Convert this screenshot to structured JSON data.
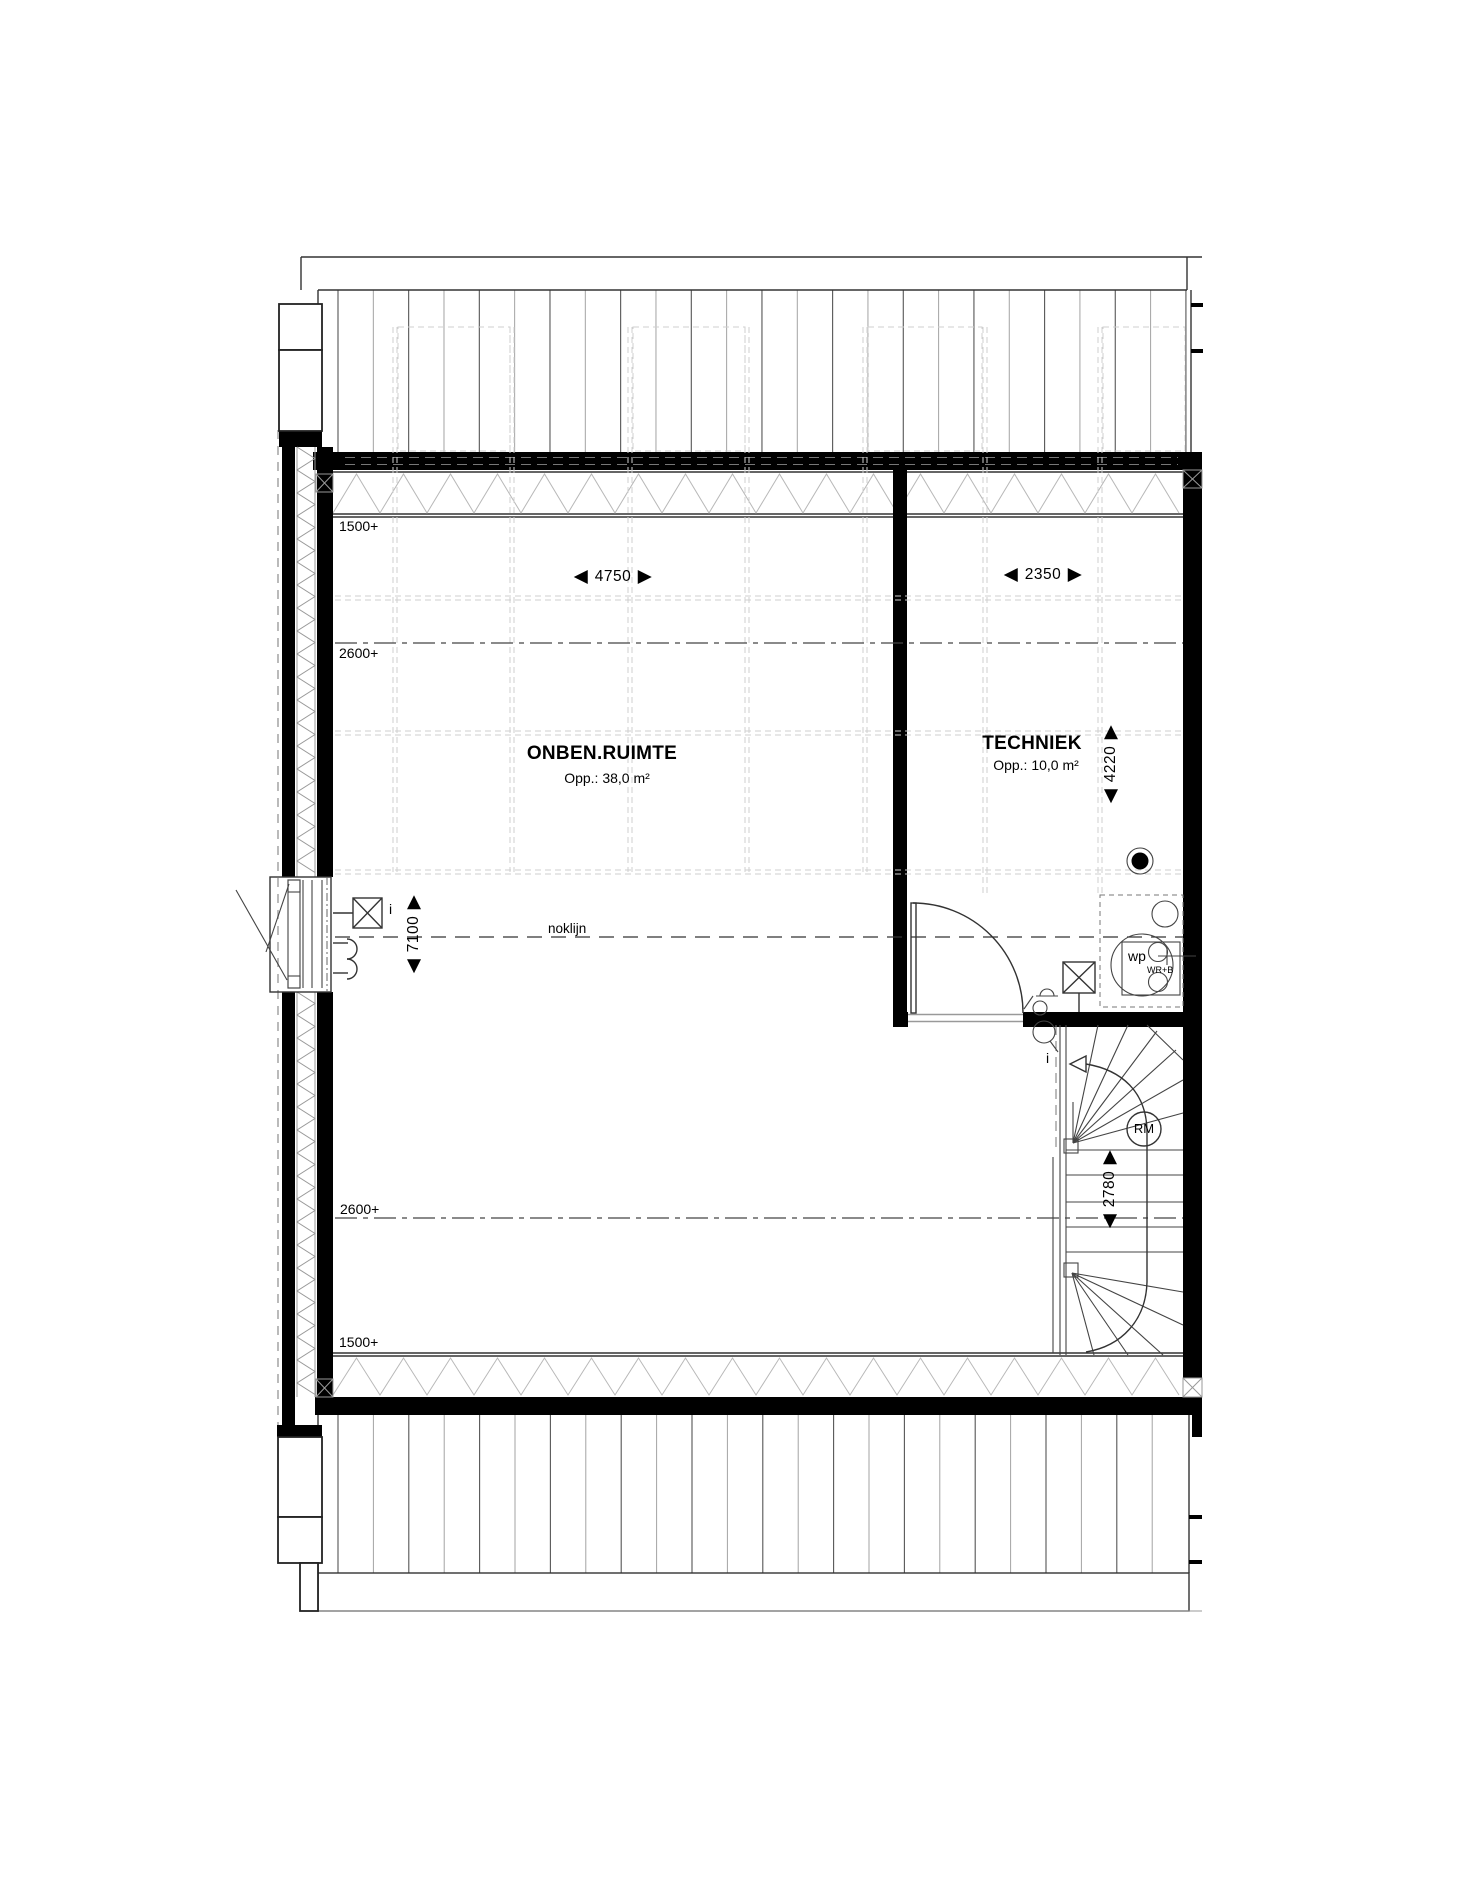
{
  "rooms": [
    {
      "name": "ONBEN.RUIMTE",
      "area": "Opp.: 38,0 m²"
    },
    {
      "name": "TECHNIEK",
      "area": "Opp.: 10,0 m²"
    }
  ],
  "dimensions": {
    "main_width": "4750",
    "techniek_width": "2350",
    "techniek_height": "4220",
    "main_height": "7100",
    "stair_height": "2780"
  },
  "levels": {
    "top_1500": "1500+",
    "top_2600": "2600+",
    "bottom_2600": "2600+",
    "bottom_1500": "1500+"
  },
  "annotations": {
    "ridge_line": "noklijn",
    "smoke_detector": "RM",
    "heat_pump": "wp",
    "heat_pump_sub": "WR+B",
    "window_info": "i",
    "door_info": "i"
  },
  "colors": {
    "wall": "#000000",
    "line": "#333333",
    "faint_grid": "#cfcfcf",
    "insulation_hatch": "#b8b8b8"
  }
}
